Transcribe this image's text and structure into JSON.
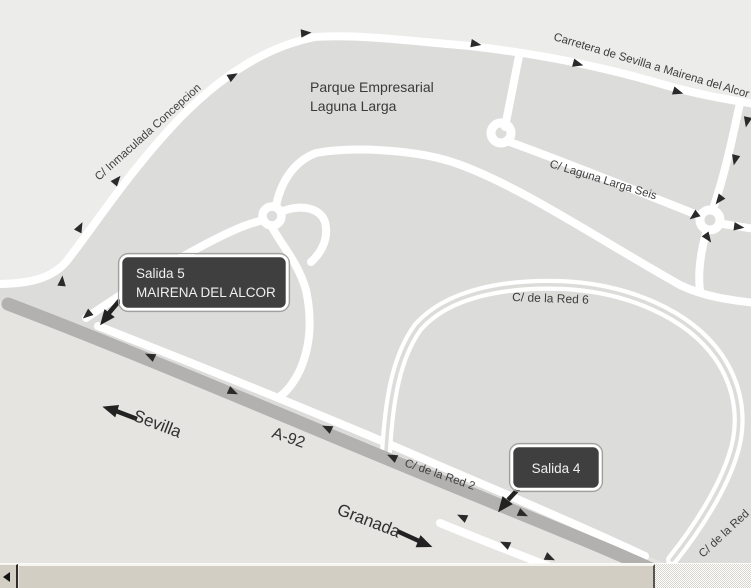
{
  "map": {
    "area_label": {
      "line1": "Parque Empresarial",
      "line2": "Laguna Larga"
    },
    "streets": {
      "inmaculada": "C/ Inmaculada Concepcion",
      "carretera": "Carretera de Sevilla a Mairena del Alcor",
      "laguna_seis": "C/ Laguna Larga Seis",
      "red6": "C/ de la Red 6",
      "red2": "C/ de la Red 2",
      "red_corner": "C/ de la Red",
      "a92": "A-92"
    },
    "exits": {
      "salida5": {
        "line1": "Salida 5",
        "line2": "MAIRENA DEL ALCOR"
      },
      "salida4": {
        "label": "Salida 4"
      }
    },
    "directions": {
      "sevilla": "Sevilla",
      "granada": "Granada"
    },
    "colors": {
      "background": "#ececeb",
      "block": "#dcdcdb",
      "below_highway": "#e6e4e1",
      "road": "#ffffff",
      "highway": "#b2b1af",
      "arrow": "#2a2a2a",
      "street_text": "#3e3e3e",
      "exit_sign_bg": "#3f3f3f",
      "exit_sign_text": "#f0f0f0",
      "scrollbar_beige": "#d2cec3"
    }
  },
  "scrollbar": {
    "orientation": "horizontal",
    "left_button": "left-arrow"
  }
}
